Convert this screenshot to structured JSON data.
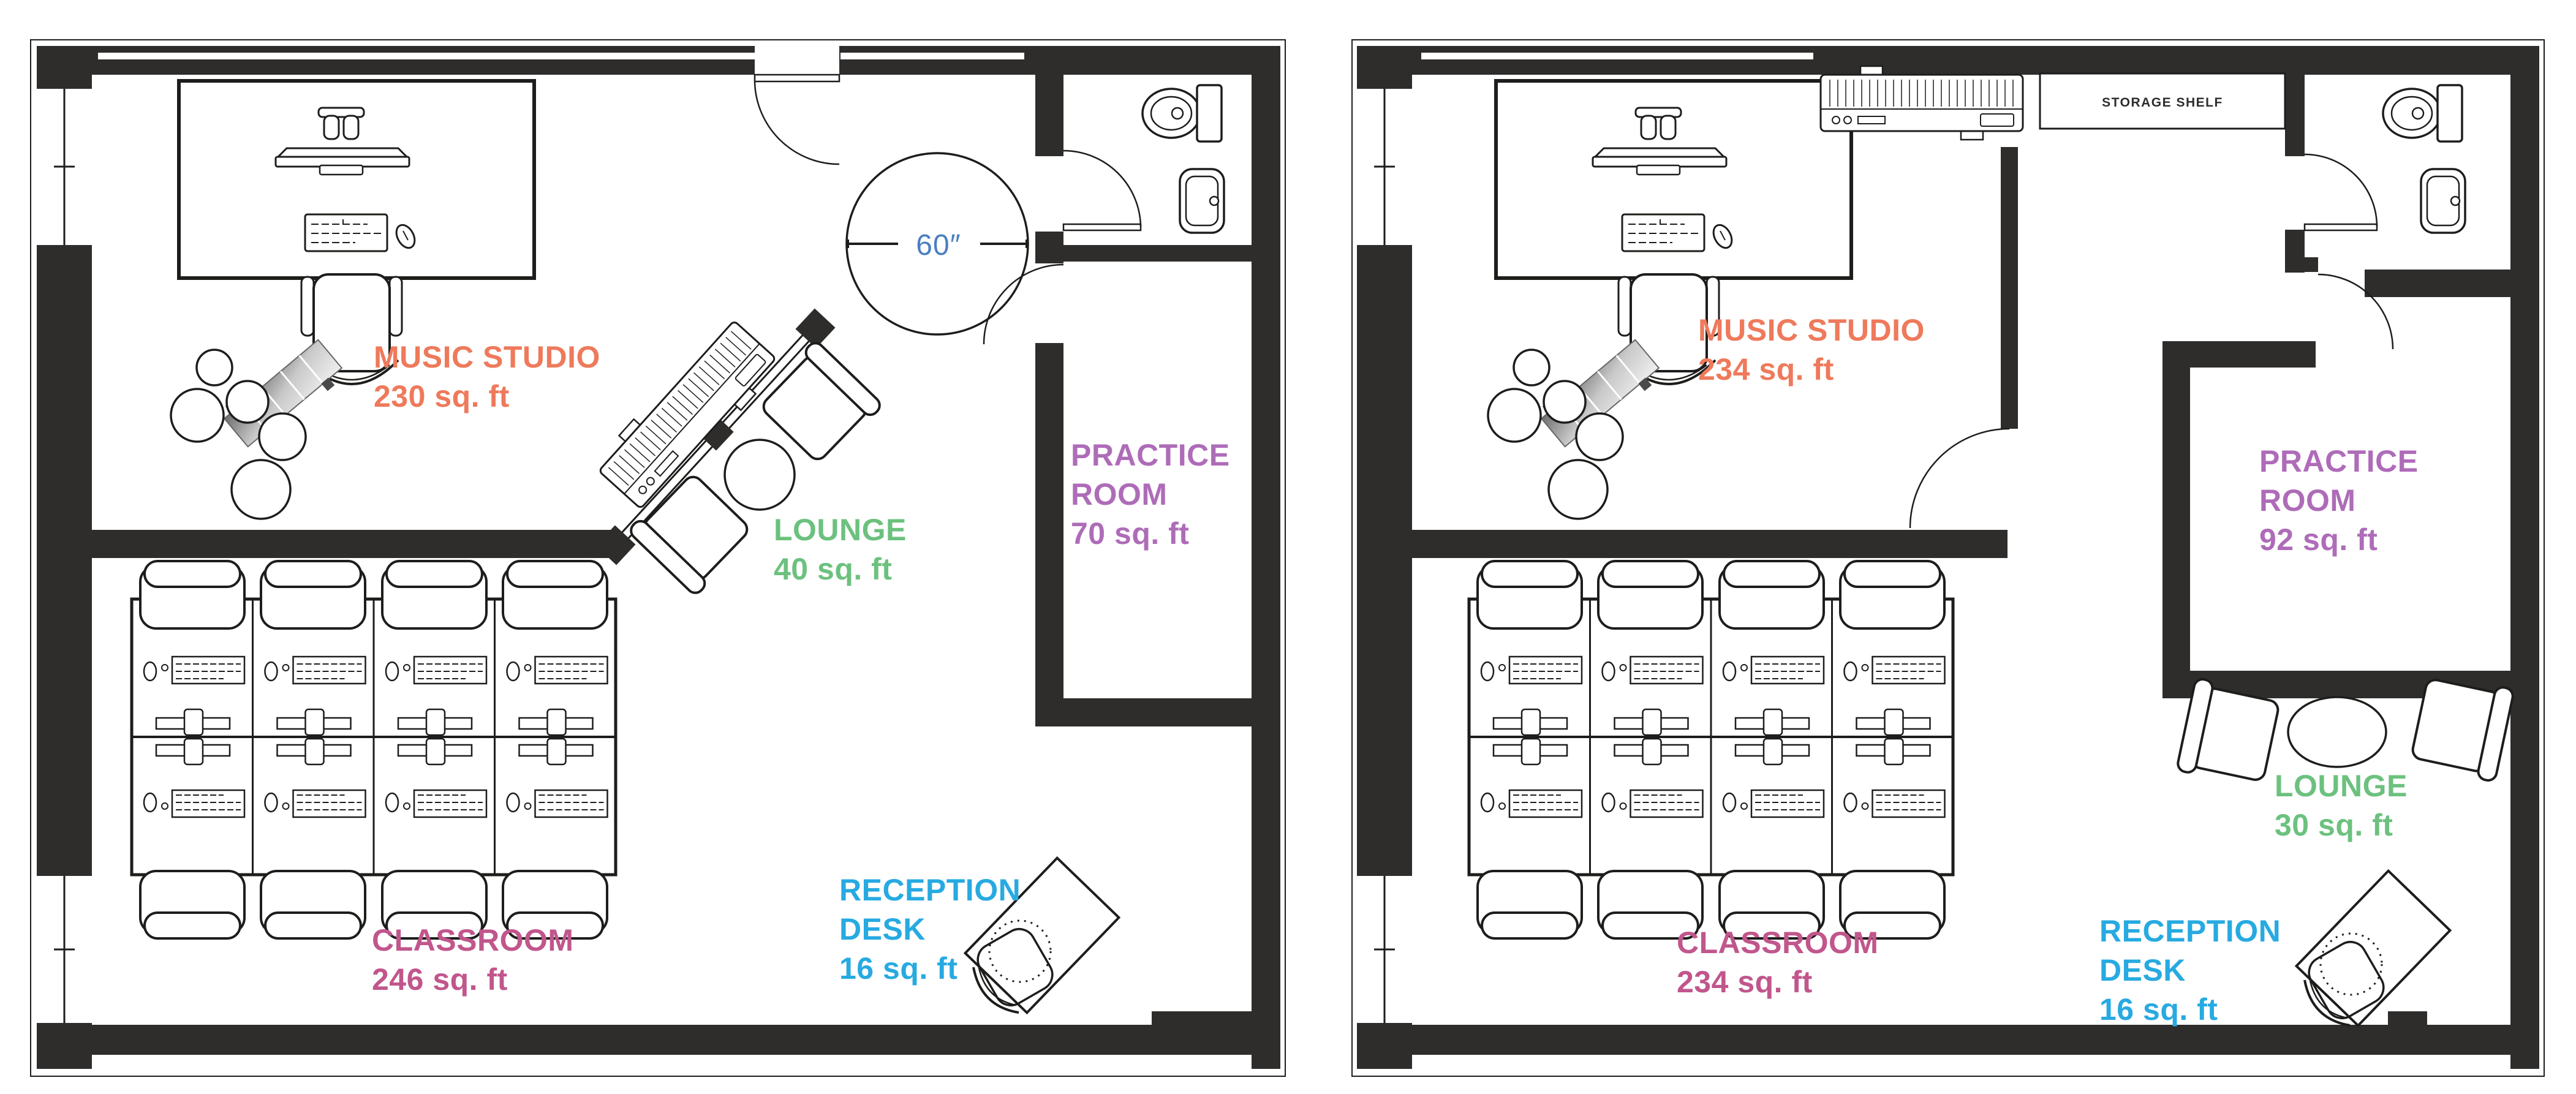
{
  "figure": {
    "kind": "floor-plan-comparison",
    "background": "#ffffff"
  },
  "palette": {
    "wall": "#2e2d2c",
    "furniture_line": "#1d1d1b",
    "music_studio": "#ee7a5b",
    "lounge": "#6cc17e",
    "practice_room": "#ae6cb8",
    "classroom": "#c1568c",
    "reception_desk": "#27aae1",
    "dimension_blue": "#4a7fc1"
  },
  "plans": [
    {
      "id": "plan-left",
      "rooms": [
        {
          "id": "music-studio",
          "line1": "MUSIC STUDIO",
          "area": "230 sq. ft",
          "color": "#ee7a5b"
        },
        {
          "id": "lounge",
          "line1": "LOUNGE",
          "area": "40 sq. ft",
          "color": "#6cc17e"
        },
        {
          "id": "practice-room",
          "line1": "PRACTICE",
          "line2": "ROOM",
          "area": "70 sq. ft",
          "color": "#ae6cb8"
        },
        {
          "id": "classroom",
          "line1": "CLASSROOM",
          "area": "246 sq. ft",
          "color": "#c1568c"
        },
        {
          "id": "reception-desk",
          "line1": "RECEPTION",
          "line2": "DESK",
          "area": "16 sq. ft",
          "color": "#27aae1"
        }
      ],
      "annotations": [
        {
          "id": "door-clearance",
          "text": "60″",
          "color": "#4a7fc1"
        }
      ]
    },
    {
      "id": "plan-right",
      "rooms": [
        {
          "id": "music-studio",
          "line1": "MUSIC STUDIO",
          "area": "234 sq. ft",
          "color": "#ee7a5b"
        },
        {
          "id": "lounge",
          "line1": "LOUNGE",
          "area": "30 sq. ft",
          "color": "#6cc17e"
        },
        {
          "id": "practice-room",
          "line1": "PRACTICE",
          "line2": "ROOM",
          "area": "92 sq. ft",
          "color": "#ae6cb8"
        },
        {
          "id": "classroom",
          "line1": "CLASSROOM",
          "area": "234 sq. ft",
          "color": "#c1568c"
        },
        {
          "id": "reception-desk",
          "line1": "RECEPTION",
          "line2": "DESK",
          "area": "16 sq. ft",
          "color": "#27aae1"
        }
      ],
      "annotations": [
        {
          "id": "storage-shelf",
          "text": "STORAGE SHELF",
          "color": "#2e2d2c"
        }
      ]
    }
  ]
}
